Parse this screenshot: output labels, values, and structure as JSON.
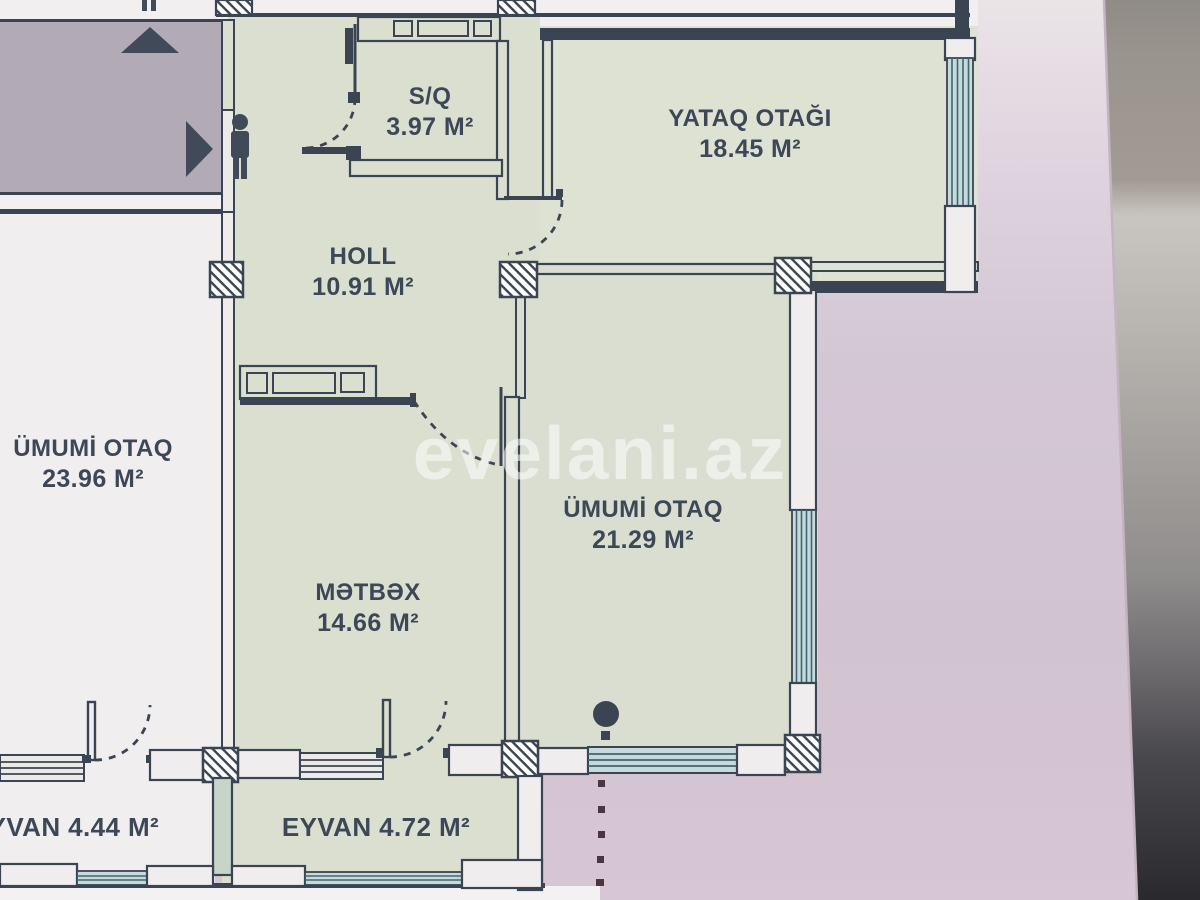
{
  "watermark": "evelani.az",
  "rooms": {
    "sq": {
      "name": "S/Q",
      "area": "3.97 M²"
    },
    "yataq": {
      "name": "YATAQ OTAĞI",
      "area": "18.45 M²"
    },
    "holl": {
      "name": "HOLL",
      "area": "10.91 M²"
    },
    "umumi_sol": {
      "name": "ÜMUMİ OTAQ",
      "area": "23.96 M²"
    },
    "umumi_sag": {
      "name": "ÜMUMİ OTAQ",
      "area": "21.29 M²"
    },
    "metbex": {
      "name": "MƏTBƏX",
      "area": "14.66 M²"
    },
    "eyvan_sol": {
      "label": "EYVAN 4.44 M²"
    },
    "eyvan_sag": {
      "label": "EYVAN 4.72 M²"
    }
  },
  "icons": {
    "up_arrow": "up-arrow-icon",
    "entrance_arrow": "entrance-arrow-icon",
    "person": "person-icon"
  },
  "colors": {
    "wall": "#3b4452",
    "room_fill": "#dadfd0",
    "neighbor_fill": "#f1eef0",
    "outside_paper": "#d2c5d3",
    "corridor": "#b2aab4",
    "window_fill": "#c6dadb",
    "window_line": "#3e6672",
    "label_text": "#3d4757",
    "watermark_color": "rgba(255,255,255,0.55)"
  }
}
